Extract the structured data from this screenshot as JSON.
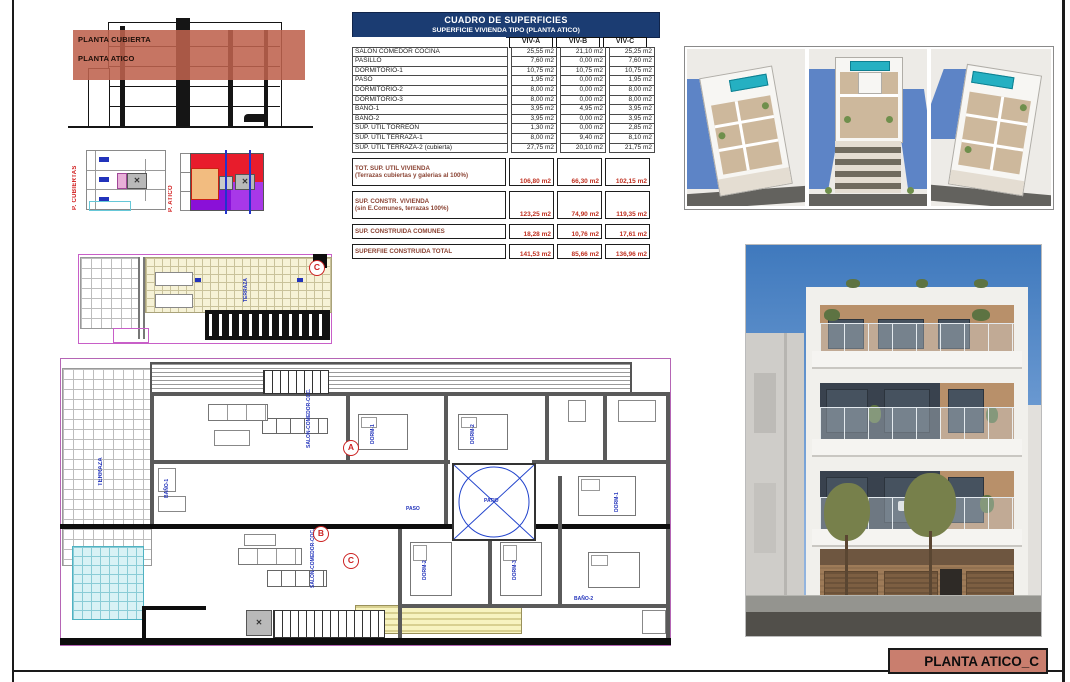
{
  "section_diagram": {
    "label_cubierta": "PLANTA CUBIERTA",
    "label_atico": "PLANTA ATICO",
    "overlay_color": "#be624d"
  },
  "key_plans": {
    "cubiertas_label": "P. CUBIERTAS",
    "atico_label": "P. ATICO"
  },
  "table": {
    "title": "CUADRO DE SUPERFICIES",
    "subtitle": "SUPERFICIE VIVIENDA TIPO  (PLANTA ATICO)",
    "columns": [
      "VIV-A",
      "VIV-B",
      "VIV-C"
    ],
    "rows": [
      {
        "label": "SALON COMEDOR COCINA",
        "values": [
          "25,55 m2",
          "21,10 m2",
          "25,25 m2"
        ]
      },
      {
        "label": "PASILLO",
        "values": [
          "7,60 m2",
          "0,00 m2",
          "7,60 m2"
        ]
      },
      {
        "label": "DORMITORIO-1",
        "values": [
          "10,75 m2",
          "10,75 m2",
          "10,75 m2"
        ]
      },
      {
        "label": "PASO",
        "values": [
          "1,95 m2",
          "0,00 m2",
          "1,95 m2"
        ]
      },
      {
        "label": "DORMITORIO-2",
        "values": [
          "8,00 m2",
          "0,00 m2",
          "8,00 m2"
        ]
      },
      {
        "label": "DORMITORIO-3",
        "values": [
          "8,00 m2",
          "0,00 m2",
          "8,00 m2"
        ]
      },
      {
        "label": "BAÑO-1",
        "values": [
          "3,95 m2",
          "4,95 m2",
          "3,95 m2"
        ]
      },
      {
        "label": "BAÑO-2",
        "values": [
          "3,95 m2",
          "0,00 m2",
          "3,95 m2"
        ]
      },
      {
        "label": "SUP. ÚTIL TORREON",
        "values": [
          "1,30 m2",
          "0,00 m2",
          "2,85 m2"
        ]
      },
      {
        "label": "SUP. ÚTIL TERRAZA-1",
        "values": [
          "8,00 m2",
          "9,40 m2",
          "8,10 m2"
        ]
      },
      {
        "label": "SUP. ÚTIL TERRAZA-2 (cubierta)",
        "values": [
          "27,75 m2",
          "20,10 m2",
          "21,75 m2"
        ]
      }
    ],
    "summary": [
      {
        "label": "TOT. SUP. UTIL VIVIENDA",
        "sublabel": "(Terrazas cubiertas y galerias al 100%)",
        "values": [
          "106,80 m2",
          "66,30 m2",
          "102,15 m2"
        ],
        "tall": true
      },
      {
        "label": "SUP. CONSTR. VIVIENDA",
        "sublabel": "(sin E.Comunes, terrazas 100%)",
        "values": [
          "123,25 m2",
          "74,90 m2",
          "119,35 m2"
        ],
        "tall": true
      },
      {
        "label": "SUP. CONSTRUIDA COMUNES",
        "sublabel": "",
        "values": [
          "18,28 m2",
          "10,76 m2",
          "17,61 m2"
        ],
        "tall": false
      },
      {
        "label": "SUPERFIIE CONSTRUIDA TOTAL",
        "sublabel": "",
        "values": [
          "141,53 m2",
          "85,66 m2",
          "136,96 m2"
        ],
        "tall": false
      }
    ]
  },
  "markers": {
    "a": "A",
    "b": "B",
    "c": "C"
  },
  "plan_labels": {
    "terraza": "TERRAZA",
    "salon": "SALON-COMEDOR-COC.",
    "dorm1": "DORM-1",
    "dorm2": "DORM-2",
    "dorm3": "DORM-3",
    "bano1": "BAÑO-1",
    "bano2": "BAÑO-2",
    "paso": "PASO",
    "patio": "PATIO"
  },
  "title_block": {
    "text": "PLANTA ATICO_C",
    "bg_color": "#c97e6e"
  },
  "colors": {
    "header_navy": "#1b3c72",
    "summary_red": "#c03020",
    "overlay_salmon": "#be624d",
    "plan_magenta": "#c85fc8",
    "pool_teal": "#25b0c2"
  }
}
